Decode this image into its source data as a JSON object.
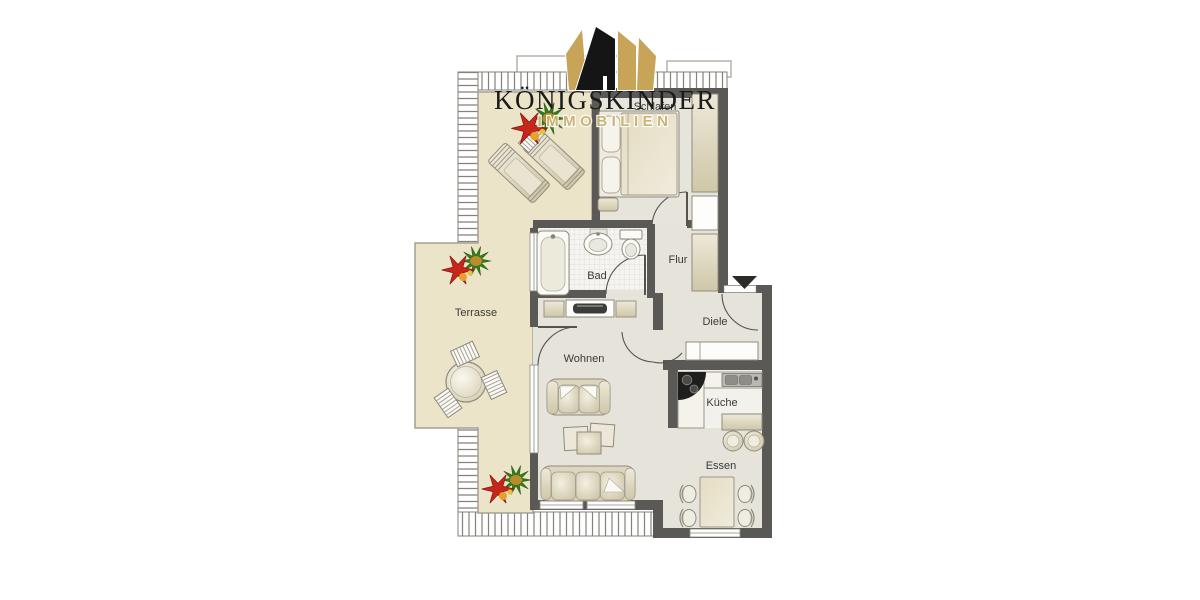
{
  "type": "real-estate-floor-plan",
  "logo": {
    "title": "KÖNIGSKINDER",
    "subtitle": "IMMOBILIEN",
    "crown_icon": "crown-icon",
    "crown_gold": "#c7a458",
    "crown_black": "#151515",
    "title_color": "#1b1b1b",
    "subtitle_color": "#c9b171"
  },
  "rooms": [
    {
      "id": "schlafen",
      "label": "Schlafen"
    },
    {
      "id": "bad",
      "label": "Bad"
    },
    {
      "id": "flur",
      "label": "Flur"
    },
    {
      "id": "diele",
      "label": "Diele"
    },
    {
      "id": "wohnen",
      "label": "Wohnen"
    },
    {
      "id": "kueche",
      "label": "Küche"
    },
    {
      "id": "essen",
      "label": "Essen"
    },
    {
      "id": "terrasse",
      "label": "Terrasse"
    }
  ],
  "markers": {
    "entrance_arrow_icon": "triangle-down",
    "entrance_arrow_color": "#2b2b28"
  },
  "palette": {
    "wall": "#5a5955",
    "interior_floor": "#e6e3db",
    "bedroom_floor": "#e7e4dc",
    "terrace_floor": "#ece4c9",
    "bath_floor": "#f5f4f0",
    "kitchen_floor": "#f2f1ec",
    "furniture_light": "#eee8d8",
    "furniture_dark": "#cfc7a8",
    "furniture_outline": "#8f8c7c",
    "hatch_line": "#85827a",
    "plant_red": "#c5271b",
    "plant_green": "#3a7a1e",
    "plant_orange": "#e8a02c"
  },
  "furniture": {
    "schlafen": [
      "double-bed",
      "pillows",
      "nightstand",
      "wardrobe",
      "shelf-niche"
    ],
    "flur": [
      "built-in-cabinet"
    ],
    "bad": [
      "bathtub",
      "washbasin",
      "toilet"
    ],
    "diele": [
      "cupboard"
    ],
    "wohnen": [
      "tv-lowboard",
      "two-seat-sofa",
      "coffee-table-set",
      "three-seat-sofa"
    ],
    "kueche": [
      "corner-counter",
      "stove",
      "kitchen-sink",
      "bar-table",
      "two-stools"
    ],
    "essen": [
      "dining-table",
      "four-chairs"
    ],
    "terrasse": [
      "two-sun-loungers",
      "side-table",
      "round-table",
      "three-chairs",
      "plants"
    ]
  }
}
